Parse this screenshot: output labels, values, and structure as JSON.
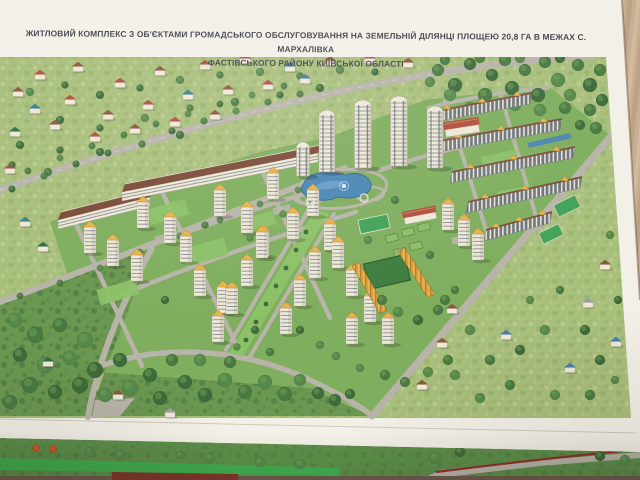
{
  "poster": {
    "title_line1": "ЖИТЛОВИЙ КОМПЛЕКС З ОБ'ЄКТАМИ ГРОМАДСЬКОГО ОБСЛУГОВУВАННЯ НА ЗЕМЕЛЬНІЙ ДІЛЯНЦІ ПЛОЩЕЮ 20,8 ГА В МЕЖАХ С. МАРХАЛІВКА",
    "title_line2": "ФАСТІВСЬКОГО РАЙОНУ КИЇВСЬКОЇ ОБЛАСТІ"
  },
  "palette": {
    "table": "#c8ad91",
    "table_dark": "#b2977c",
    "table_light": "#d6bfa3",
    "paper": "#f3f0e8",
    "title_text": "#46454f",
    "meadow": "#a9bf7c",
    "meadow_light": "#bfd194",
    "meadow_dark": "#8fae67",
    "complex_ground": "#7fae5e",
    "forest_base": "#6b9750",
    "lawn_light": "#8cc167",
    "court": "#3da257",
    "plot": "#8fbe68",
    "plot_edge": "#5c8a45",
    "pitch": "#3e7d3e",
    "hedge": "#2e5c30",
    "road": "#b8b4a9",
    "road_light": "#cdc8b8",
    "path": "#d8d3c2",
    "building_wall": "#eee8d8",
    "building_edge": "#a59f90",
    "window": "#6d747c",
    "window_dark": "#5a626b",
    "roof_yellow": "#e7b44c",
    "roof_yellow_dark": "#a87d2c",
    "roof_brown": "#7b4a38",
    "row_roof": "#7b4f3a",
    "town_roof": "#d99f3d",
    "town_roof_dark": "#b57f2a",
    "water": "#4a86b4",
    "water_dark": "#35648c",
    "water_light": "#7db0d4",
    "tree_dark": "#3e6b3a",
    "tree_mid": "#4a7a42",
    "tree_light": "#57894b",
    "tree_hi": "#6fa258",
    "fence_red": "#8e2f2a",
    "sheet2_green": "#5d8f4a",
    "sheet2_lawn": "#3fae4e",
    "sheet2_dark": "#6e5a4d",
    "sheet2_maroon": "#7e352c",
    "orange_tree": "#cf5527",
    "roofs": {
      "red": "#b0503c",
      "brown": "#8a5a3c",
      "teal": "#37808a",
      "green": "#2f7044",
      "blue": "#4a7fa8",
      "gray": "#9aa0a0"
    }
  },
  "scene": {
    "housesTop": [
      [
        18,
        95,
        "brown"
      ],
      [
        40,
        78,
        "red"
      ],
      [
        78,
        70,
        "brown"
      ],
      [
        120,
        86,
        "red"
      ],
      [
        160,
        74,
        "brown"
      ],
      [
        205,
        68,
        "red"
      ],
      [
        245,
        62,
        "red"
      ],
      [
        290,
        70,
        "teal"
      ],
      [
        330,
        64,
        "brown"
      ],
      [
        370,
        62,
        "red"
      ],
      [
        408,
        66,
        "brown"
      ],
      [
        35,
        112,
        "teal"
      ],
      [
        70,
        103,
        "red"
      ],
      [
        108,
        118,
        "brown"
      ],
      [
        148,
        108,
        "red"
      ],
      [
        188,
        98,
        "teal"
      ],
      [
        228,
        93,
        "brown"
      ],
      [
        268,
        88,
        "red"
      ],
      [
        305,
        82,
        "blue"
      ],
      [
        15,
        135,
        "green"
      ],
      [
        55,
        128,
        "brown"
      ],
      [
        95,
        140,
        "red"
      ],
      [
        135,
        132,
        "brown"
      ],
      [
        175,
        125,
        "red"
      ],
      [
        215,
        118,
        "brown"
      ],
      [
        25,
        225,
        "teal"
      ],
      [
        43,
        250,
        "green"
      ],
      [
        10,
        172,
        "brown"
      ]
    ],
    "housesFront": [
      [
        48,
        365,
        "green"
      ],
      [
        118,
        398,
        "brown"
      ],
      [
        170,
        416,
        "gray"
      ],
      [
        452,
        312,
        "brown"
      ],
      [
        506,
        338,
        "blue"
      ],
      [
        570,
        371,
        "blue"
      ],
      [
        442,
        346,
        "brown"
      ],
      [
        605,
        268,
        "brown"
      ],
      [
        588,
        306,
        "gray"
      ],
      [
        616,
        345,
        "blue"
      ],
      [
        422,
        388,
        "brown"
      ]
    ],
    "towersSmall": [
      [
        143,
        228
      ],
      [
        170,
        243
      ],
      [
        113,
        266
      ],
      [
        137,
        281
      ],
      [
        90,
        253
      ],
      [
        220,
        216
      ],
      [
        247,
        233
      ],
      [
        273,
        199
      ],
      [
        263,
        256
      ],
      [
        293,
        239
      ],
      [
        313,
        216
      ],
      [
        200,
        296
      ],
      [
        223,
        313
      ],
      [
        186,
        262
      ],
      [
        262,
        258
      ],
      [
        247,
        286
      ],
      [
        232,
        314
      ],
      [
        218,
        342
      ],
      [
        330,
        250
      ],
      [
        315,
        278
      ],
      [
        300,
        306
      ],
      [
        286,
        334
      ],
      [
        338,
        268
      ],
      [
        352,
        296
      ],
      [
        370,
        322
      ],
      [
        388,
        344
      ],
      [
        352,
        344
      ],
      [
        448,
        230
      ],
      [
        464,
        246
      ],
      [
        478,
        260
      ]
    ],
    "towersTall": [
      [
        303,
        176,
        30,
        13
      ],
      [
        327,
        172,
        58,
        16
      ],
      [
        363,
        168,
        64,
        17
      ],
      [
        399,
        166,
        66,
        17
      ],
      [
        435,
        168,
        58,
        16
      ]
    ],
    "slabs": [
      [
        58,
        220,
        150,
        197
      ],
      [
        122,
        192,
        318,
        153
      ]
    ],
    "rows": [
      [
        432,
        112,
        532,
        93
      ],
      [
        440,
        141,
        562,
        119
      ],
      [
        452,
        172,
        575,
        147
      ],
      [
        468,
        202,
        582,
        177
      ],
      [
        486,
        230,
        552,
        212
      ]
    ],
    "townRows": [
      [
        398,
        252,
        428,
        298
      ],
      [
        352,
        266,
        380,
        314
      ]
    ],
    "redRoofs": [
      [
        462,
        128,
        34,
        13,
        -9
      ],
      [
        420,
        216,
        32,
        11,
        -11
      ]
    ],
    "lawns": [
      [
        168,
        212,
        40,
        16,
        -16
      ],
      [
        205,
        252,
        44,
        18,
        -16
      ],
      [
        118,
        292,
        40,
        16,
        -16
      ],
      [
        258,
        222,
        34,
        14,
        -16
      ],
      [
        288,
        156,
        26,
        11,
        -16
      ],
      [
        500,
        160,
        36,
        14,
        -12
      ],
      [
        515,
        195,
        34,
        13,
        -12
      ]
    ],
    "courts": [
      [
        374,
        224,
        30,
        14,
        -12
      ]
    ],
    "plots": [
      [
        392,
        238,
        12,
        7,
        -13
      ],
      [
        408,
        232,
        12,
        7,
        -13
      ],
      [
        424,
        227,
        12,
        7,
        -13
      ],
      [
        400,
        252,
        12,
        7,
        -13
      ],
      [
        416,
        246,
        12,
        7,
        -13
      ]
    ],
    "villagePlots": [
      [
        567,
        206,
        24,
        13,
        -26
      ],
      [
        551,
        234,
        22,
        12,
        -26
      ]
    ],
    "treesBack": [
      [
        30,
        92,
        4
      ],
      [
        65,
        85,
        3.5
      ],
      [
        100,
        95,
        4
      ],
      [
        140,
        88,
        3.5
      ],
      [
        180,
        80,
        4
      ],
      [
        220,
        75,
        3.5
      ],
      [
        260,
        72,
        4
      ],
      [
        300,
        76,
        3.5
      ],
      [
        340,
        70,
        4
      ],
      [
        375,
        72,
        3.5
      ],
      [
        60,
        120,
        4
      ],
      [
        100,
        128,
        3.5
      ],
      [
        145,
        118,
        4
      ],
      [
        190,
        108,
        3.5
      ],
      [
        235,
        102,
        4
      ],
      [
        280,
        95,
        3.5
      ],
      [
        320,
        88,
        4
      ],
      [
        20,
        145,
        4
      ],
      [
        60,
        150,
        3.5
      ],
      [
        100,
        152,
        4
      ],
      [
        142,
        144,
        3.5
      ],
      [
        180,
        135,
        4
      ],
      [
        12,
        165,
        3.5
      ],
      [
        48,
        172,
        4
      ],
      [
        12,
        189,
        3.4
      ],
      [
        44,
        176,
        3.4
      ],
      [
        76,
        164,
        3.4
      ],
      [
        108,
        153,
        3.4
      ],
      [
        172,
        131,
        3.4
      ],
      [
        204,
        121,
        3.4
      ],
      [
        236,
        111,
        3.4
      ],
      [
        268,
        102,
        3.4
      ],
      [
        300,
        94,
        3.4
      ],
      [
        28,
        171,
        3.2
      ],
      [
        60,
        158,
        3.2
      ],
      [
        92,
        146,
        3.2
      ],
      [
        124,
        135,
        3.2
      ],
      [
        156,
        124,
        3.2
      ],
      [
        188,
        114,
        3.2
      ],
      [
        220,
        104,
        3.2
      ],
      [
        252,
        95,
        3.2
      ],
      [
        284,
        86,
        3.2
      ],
      [
        20,
        296,
        3.2
      ],
      [
        60,
        283,
        3.2
      ],
      [
        100,
        268,
        3.2
      ],
      [
        140,
        252,
        3.2
      ],
      [
        180,
        236,
        3.2
      ],
      [
        220,
        220,
        3.2
      ],
      [
        260,
        204,
        3.2
      ],
      [
        298,
        190,
        3.2
      ],
      [
        438,
        70,
        6
      ],
      [
        455,
        85,
        7
      ],
      [
        470,
        64,
        6
      ],
      [
        485,
        95,
        7
      ],
      [
        492,
        75,
        6
      ],
      [
        505,
        60,
        6
      ],
      [
        512,
        88,
        7
      ],
      [
        525,
        70,
        6
      ],
      [
        538,
        95,
        7
      ],
      [
        545,
        62,
        6
      ],
      [
        558,
        80,
        7
      ],
      [
        570,
        95,
        6
      ],
      [
        578,
        65,
        6
      ],
      [
        590,
        85,
        7
      ],
      [
        600,
        70,
        6
      ],
      [
        602,
        100,
        6
      ],
      [
        590,
        110,
        6
      ],
      [
        565,
        108,
        6
      ],
      [
        540,
        110,
        6
      ],
      [
        515,
        105,
        6
      ],
      [
        470,
        108,
        6
      ],
      [
        450,
        95,
        6
      ],
      [
        596,
        128,
        6
      ],
      [
        580,
        125,
        5
      ],
      [
        430,
        82,
        5
      ],
      [
        445,
        60,
        5
      ],
      [
        560,
        58,
        5
      ],
      [
        520,
        58,
        5
      ],
      [
        480,
        58,
        5
      ]
    ],
    "treesFront": [
      [
        15,
        320,
        7
      ],
      [
        35,
        335,
        8
      ],
      [
        60,
        325,
        7
      ],
      [
        85,
        340,
        8
      ],
      [
        20,
        355,
        7
      ],
      [
        45,
        365,
        8
      ],
      [
        70,
        358,
        7
      ],
      [
        95,
        370,
        8
      ],
      [
        120,
        360,
        7
      ],
      [
        30,
        385,
        8
      ],
      [
        55,
        392,
        7
      ],
      [
        80,
        385,
        8
      ],
      [
        105,
        395,
        7
      ],
      [
        130,
        388,
        8
      ],
      [
        10,
        402,
        7
      ],
      [
        150,
        375,
        7
      ],
      [
        160,
        398,
        7
      ],
      [
        185,
        382,
        7
      ],
      [
        205,
        395,
        7
      ],
      [
        225,
        380,
        7
      ],
      [
        245,
        392,
        7
      ],
      [
        265,
        382,
        7
      ],
      [
        285,
        394,
        7
      ],
      [
        300,
        380,
        6
      ],
      [
        200,
        360,
        6
      ],
      [
        230,
        362,
        6
      ],
      [
        172,
        360,
        6
      ],
      [
        318,
        393,
        6
      ],
      [
        335,
        400,
        6
      ],
      [
        350,
        394,
        5
      ],
      [
        445,
        300,
        5
      ],
      [
        470,
        330,
        5
      ],
      [
        490,
        360,
        5
      ],
      [
        520,
        350,
        5
      ],
      [
        545,
        330,
        5
      ],
      [
        530,
        300,
        4
      ],
      [
        560,
        290,
        4
      ],
      [
        585,
        330,
        5
      ],
      [
        600,
        360,
        5
      ],
      [
        455,
        375,
        5
      ],
      [
        480,
        398,
        5
      ],
      [
        510,
        385,
        5
      ],
      [
        555,
        395,
        5
      ],
      [
        590,
        395,
        5
      ],
      [
        615,
        380,
        4
      ],
      [
        618,
        300,
        4
      ],
      [
        624,
        260,
        4
      ],
      [
        610,
        235,
        4
      ],
      [
        165,
        300,
        4
      ],
      [
        250,
        238,
        3.5
      ],
      [
        205,
        225,
        3.5
      ],
      [
        283,
        214,
        3.5
      ],
      [
        255,
        330,
        4
      ],
      [
        270,
        352,
        4
      ],
      [
        237,
        347,
        3.5
      ],
      [
        382,
        300,
        5
      ],
      [
        398,
        312,
        5
      ],
      [
        418,
        320,
        5
      ],
      [
        438,
        310,
        5
      ],
      [
        455,
        290,
        4
      ],
      [
        395,
        200,
        4
      ],
      [
        368,
        240,
        4
      ],
      [
        430,
        255,
        4
      ],
      [
        300,
        330,
        4
      ],
      [
        320,
        345,
        4
      ],
      [
        336,
        356,
        4
      ],
      [
        360,
        368,
        4
      ],
      [
        385,
        375,
        5
      ],
      [
        405,
        382,
        5
      ],
      [
        428,
        372,
        5
      ],
      [
        448,
        360,
        5
      ]
    ],
    "medianTrees": [
      [
        306,
        232,
        2.4
      ],
      [
        296,
        250,
        2.4
      ],
      [
        286,
        268,
        2.4
      ],
      [
        276,
        286,
        2.4
      ],
      [
        266,
        304,
        2.4
      ],
      [
        256,
        322,
        2.4
      ],
      [
        246,
        340,
        2.4
      ]
    ],
    "gazebos": [
      [
        310,
        202
      ],
      [
        364,
        198
      ]
    ],
    "sheet2Trees": [
      [
        90,
        452,
        5
      ],
      [
        120,
        455,
        5
      ],
      [
        180,
        455,
        4
      ],
      [
        210,
        458,
        5
      ],
      [
        260,
        462,
        5
      ],
      [
        300,
        464,
        5
      ],
      [
        435,
        458,
        6
      ],
      [
        460,
        452,
        5
      ],
      [
        600,
        456,
        5
      ],
      [
        625,
        460,
        5
      ]
    ],
    "orangeTrees": [
      [
        36,
        448,
        3.5
      ],
      [
        53,
        449,
        3.5
      ]
    ]
  }
}
